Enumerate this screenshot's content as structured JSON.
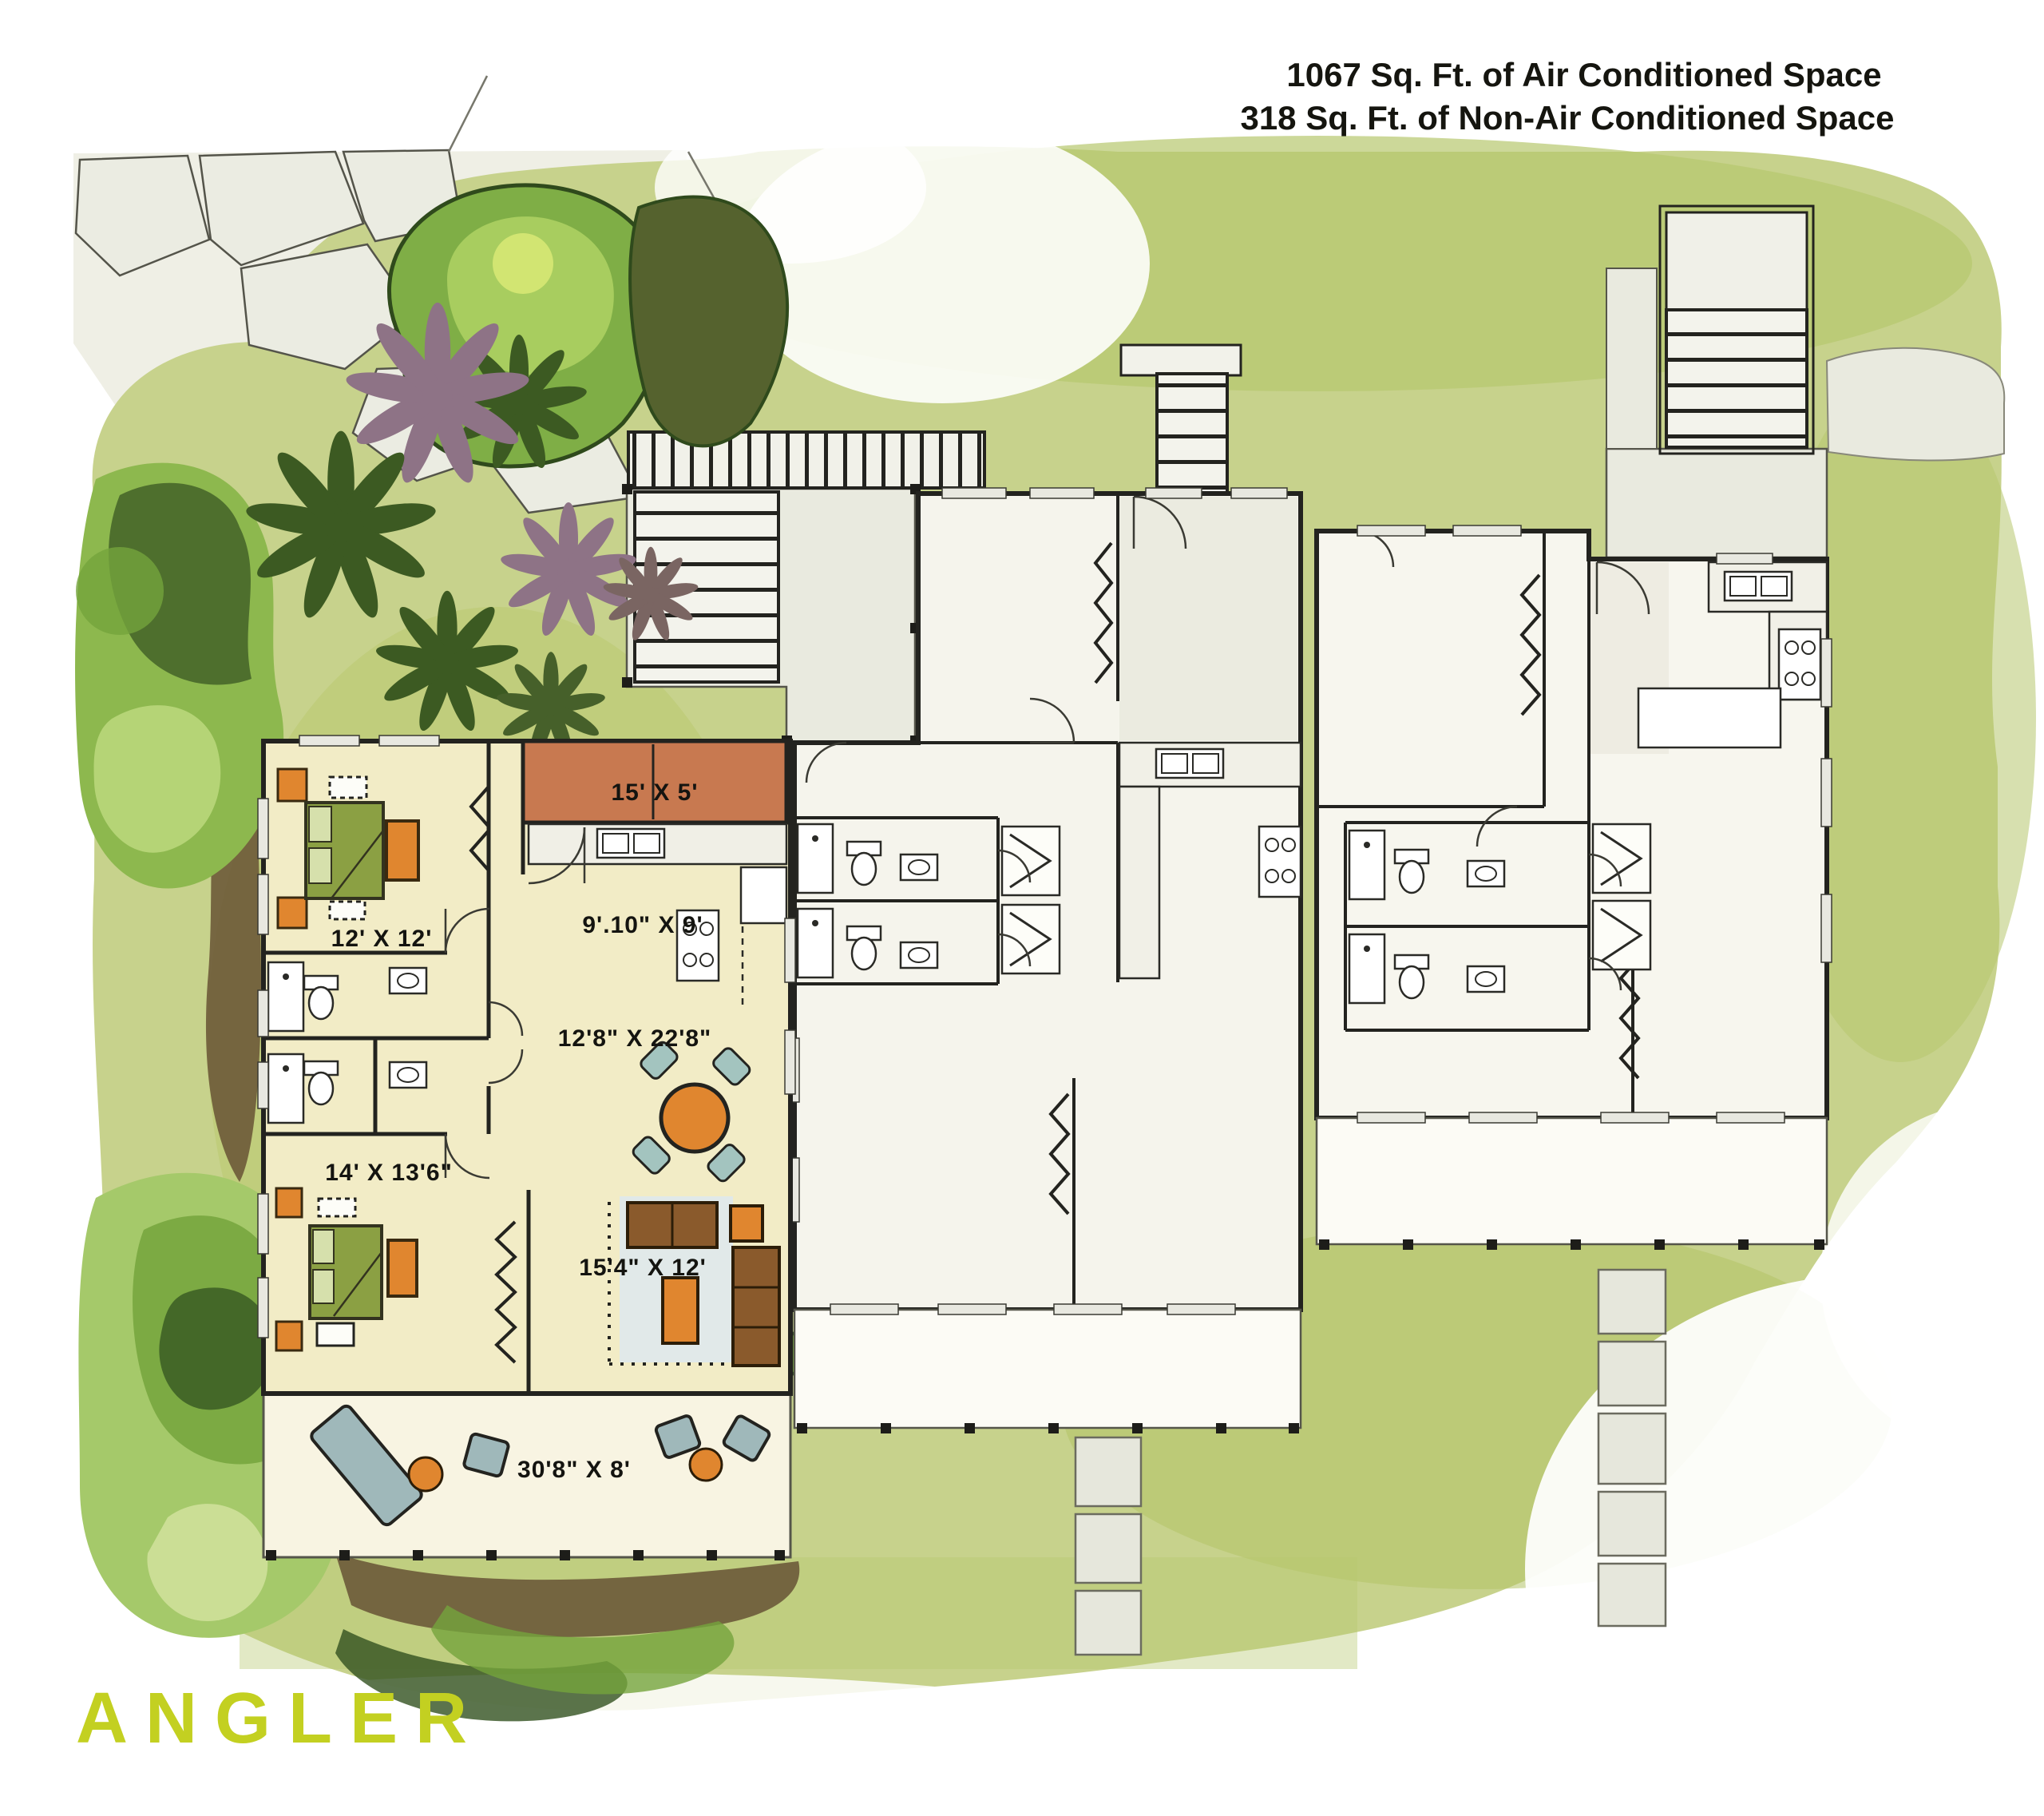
{
  "header": {
    "line1": "1067 Sq. Ft. of Air Conditioned Space",
    "line2": "318 Sq. Ft. of Non-Air Conditioned Space"
  },
  "plan": {
    "featured_unit": {
      "rooms": [
        {
          "name": "entry-porch",
          "label": "15' X 5'"
        },
        {
          "name": "kitchen",
          "label": "9'.10\" X 9'"
        },
        {
          "name": "bedroom",
          "label": "12' X 12'"
        },
        {
          "name": "dining-living",
          "label": "12'8\" X 22'8\""
        },
        {
          "name": "master-bedroom",
          "label": "14' X 13'6\""
        },
        {
          "name": "family-room",
          "label": "15'4\" X 12'"
        },
        {
          "name": "lanai",
          "label": "30'8\" X 8'"
        }
      ]
    }
  },
  "logo": {
    "text": "ANGLER",
    "color": "#c3d021"
  },
  "palette": {
    "paper": "#ffffff",
    "grass": "#c7d28c",
    "grass_dark": "#aabf66",
    "foliage_dark": "#3c5a22",
    "foliage_mid": "#74a43c",
    "foliage_light": "#a8cd5f",
    "plant_purple": "#8e7386",
    "mulch_brown": "#6d5a38",
    "walkway_gray": "#e9eadf",
    "wall_black": "#23231f",
    "floor_cream": "#f2ecc6",
    "entry_terracotta": "#c87950",
    "furniture_orange": "#e0862f",
    "bed_green": "#8ba043",
    "seat_teal": "#a3c4bf",
    "rug_blue": "#dfe9ec",
    "logo_green": "#c3d021"
  }
}
